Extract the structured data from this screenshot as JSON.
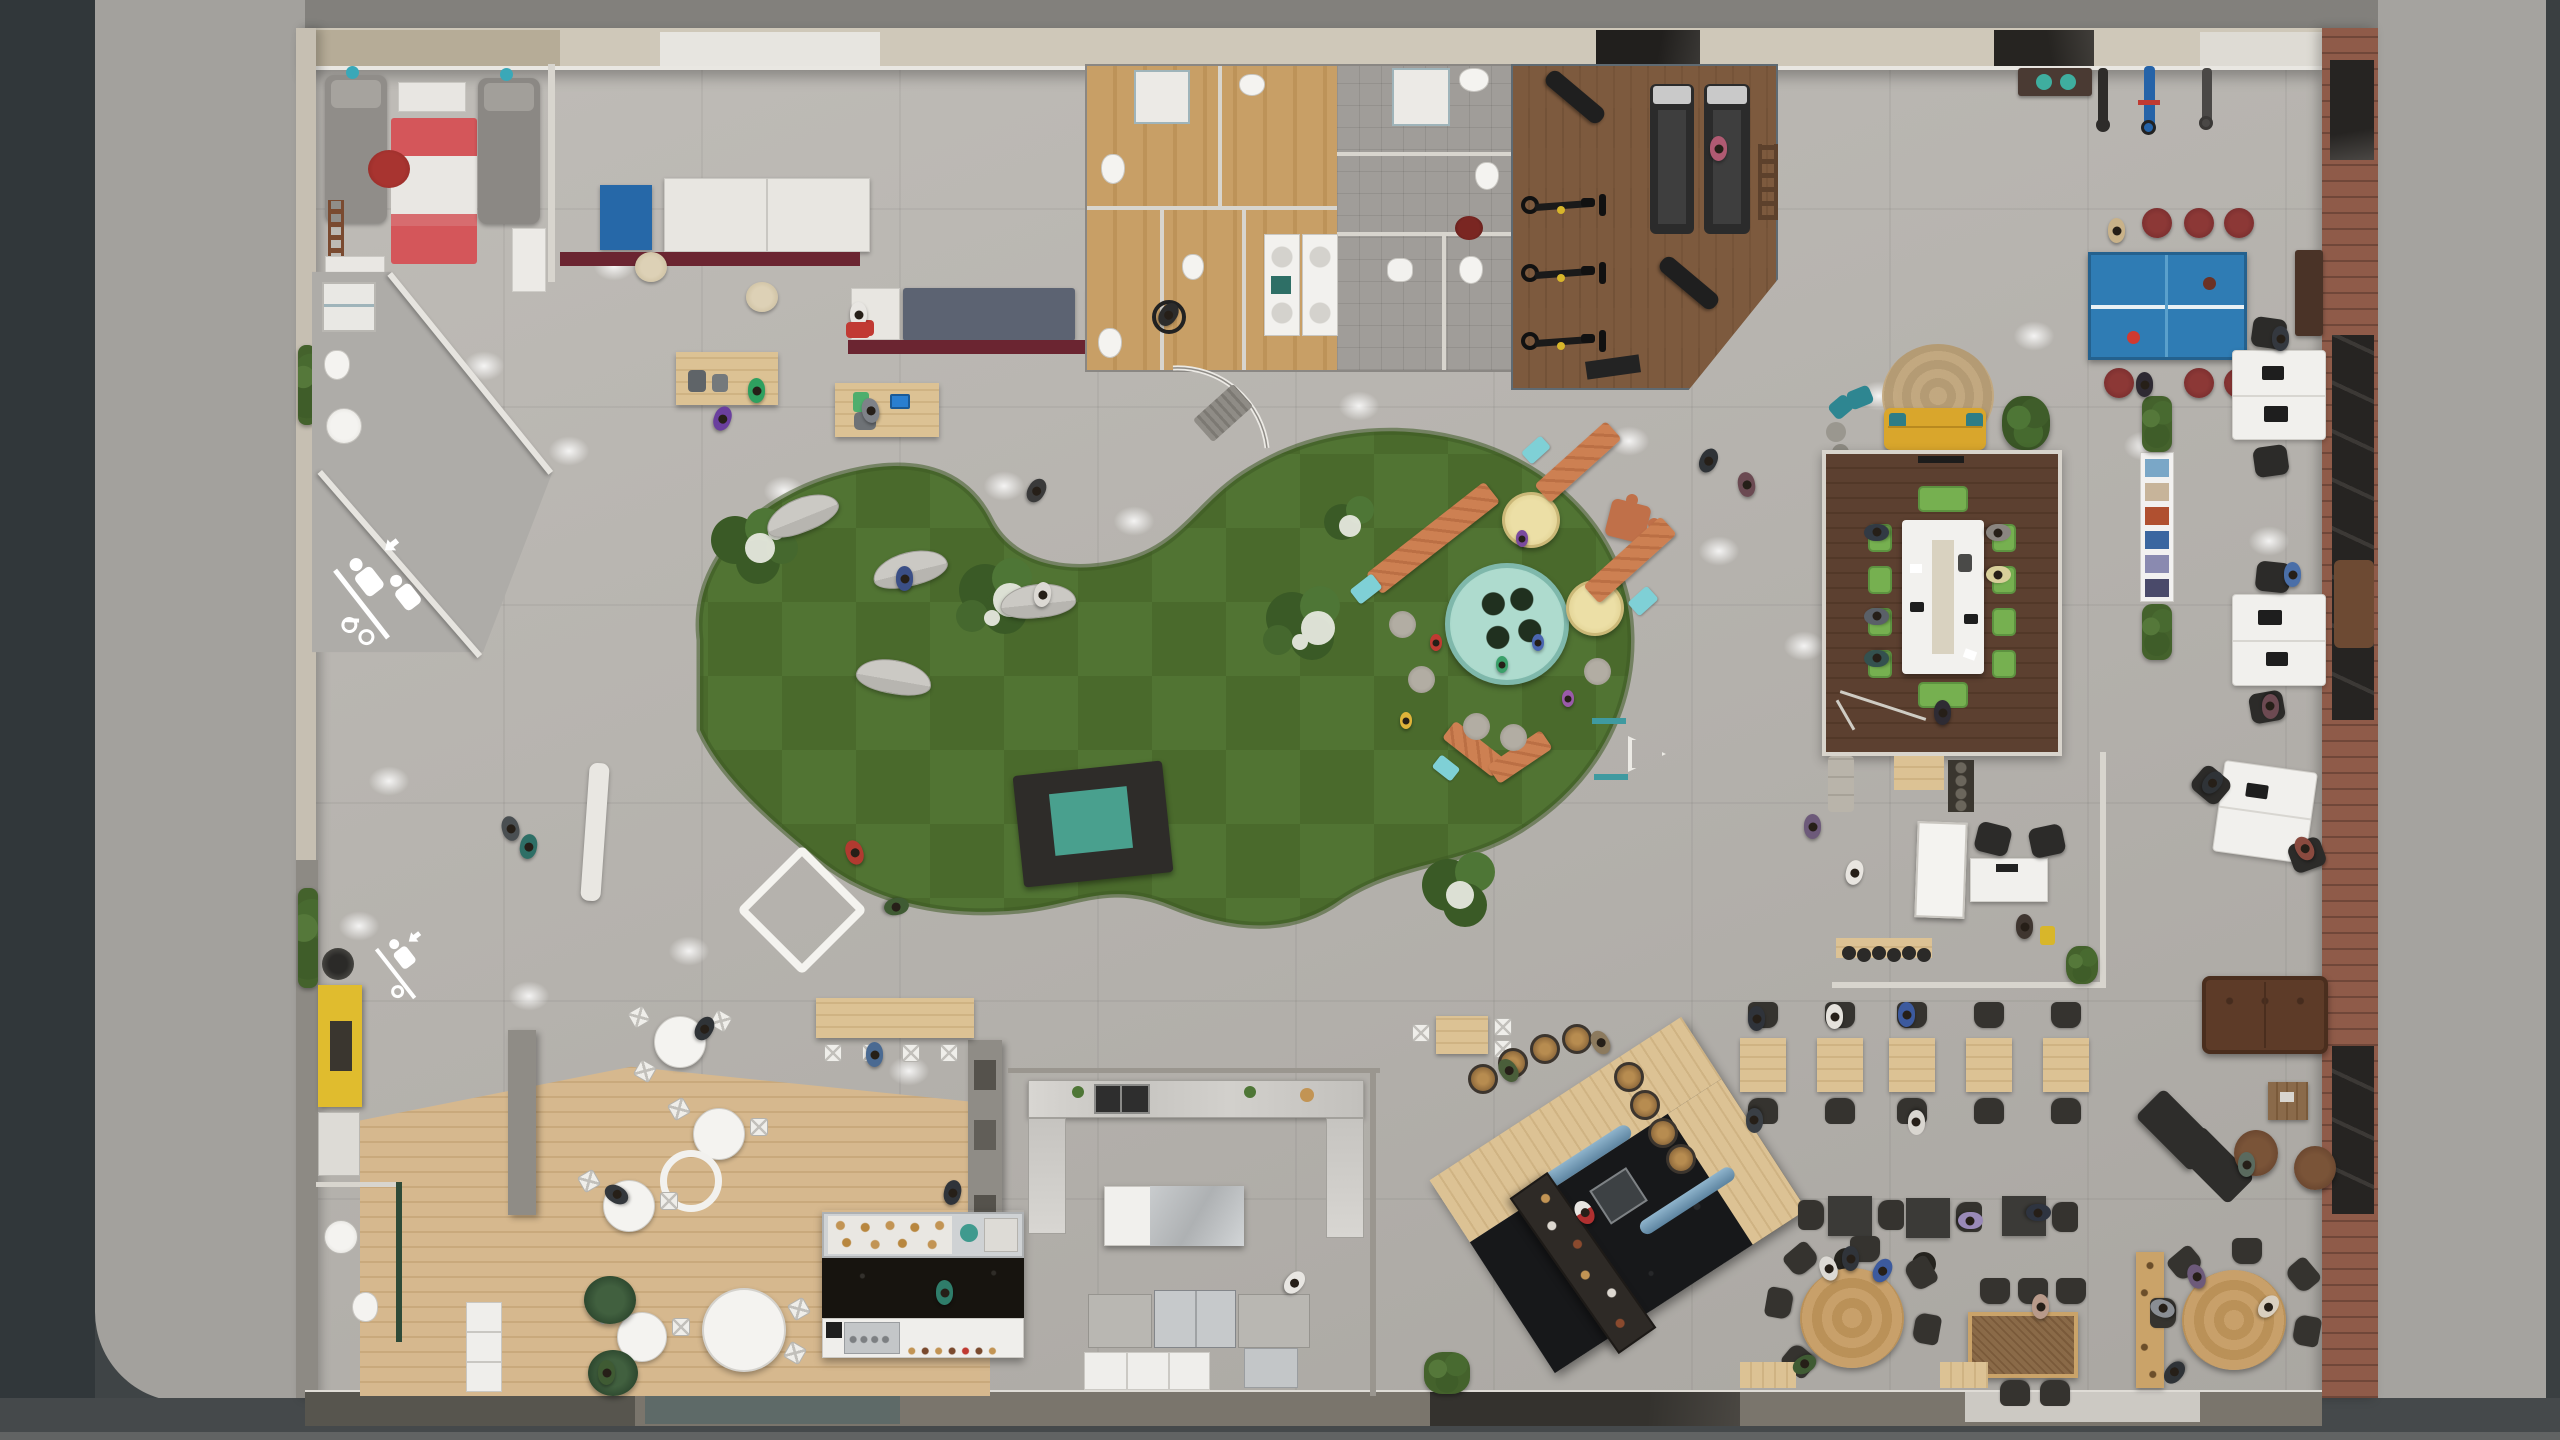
{
  "scene": {
    "title": "Top-down 3D architectural render of an open-plan office / coworking floor",
    "view": "orthographic top-down",
    "palette": {
      "street": "#3f4446",
      "sidewalk": "#a3a19d",
      "interior_concrete": "#bab7b2",
      "lawn_green_light": "#517433",
      "lawn_green_dark": "#4a6a2c",
      "cafe_wood": "#d6b88e",
      "restroom_wood": "#c89f66",
      "gym_wood": "#7d5a3e",
      "meeting_room_wood": "#5c4030",
      "pine_furniture": "#dcc294",
      "maroon_counter": "#6b2531",
      "navy_bench": "#5c6372",
      "ping_pong_blue": "#2f7cb4",
      "stool_dark_red": "#7c2f30",
      "conference_chair_green": "#76b050",
      "play_teal": "#7fd0d6",
      "pool_teal": "#a9d9cc",
      "play_orange": "#cd8052",
      "sofa_yellow": "#d9a62c",
      "booth_yellow": "#e0bc2e",
      "brick_wall": "#8f5b49",
      "black_marble": "#26221f",
      "leather_brown": "#5d3b28",
      "barrel_wood": "#a07844",
      "rug_red": "#d4565a"
    }
  },
  "zones": {
    "street": {
      "label": "Street pavement"
    },
    "sidewalk": {
      "label": "Sidewalk"
    },
    "building": {
      "label": "Open-plan office floor"
    },
    "napRoom": {
      "label": "Nap room with beds and striped rug"
    },
    "napBath": {
      "label": "Bathroom with angled glass walls"
    },
    "flexLounge": {
      "label": "Lobby flex lounge with cabinets, benches and picnic tables"
    },
    "restrooms": {
      "label": "Restroom block with wooden stalls and tiled showers"
    },
    "gym": {
      "label": "Fitness area with treadmills, spin bikes and benches"
    },
    "entrance": {
      "label": "Curved glass entrance"
    },
    "lawn": {
      "label": "Indoor lawn with checkered mowing pattern"
    },
    "playground": {
      "label": "Kids playground with button pool and stepped benches"
    },
    "pingpong": {
      "label": "Ping-pong corner"
    },
    "bikeParking": {
      "label": "Indoor bike parking"
    },
    "yellowLounge": {
      "label": "Yellow sofa lounge"
    },
    "meetingRoom": {
      "label": "Conference room with green chairs"
    },
    "serviceBar": {
      "label": "Glass service desk enclosure"
    },
    "deskRow": {
      "label": "Workstation desk pairs"
    },
    "magazineRack": {
      "label": "Magazine rack with hedge planters"
    },
    "cafe": {
      "label": "Cafe seating on wooden floor"
    },
    "cafeCounter": {
      "label": "Bakery and coffee counter"
    },
    "kitchen": {
      "label": "Commercial kitchen with granite counters"
    },
    "bar": {
      "label": "Rotated bar island with barrel stools"
    },
    "dining": {
      "label": "Dining and collaboration tables"
    },
    "leatherLounge": {
      "label": "Leather chesterfield lounge"
    },
    "wc": {
      "label": "Small WC"
    },
    "phoneBooth": {
      "label": "Yellow phone booth"
    }
  },
  "icons": [
    {
      "name": "pedestrian-bicycle-floor-marking",
      "description": "white painted pedestrians, bicycle and arrow on concrete"
    },
    {
      "name": "diamond-floor-marking",
      "description": "white diamond outline painted on lawn"
    },
    {
      "name": "triangle-floor-marking",
      "description": "white triangle outline painted on lawn"
    }
  ],
  "objects": {
    "ping_pong_tables": 1,
    "ping_pong_stools": 6,
    "barrel_stools": 8,
    "treadmills": 2,
    "spin_bikes": 3,
    "workout_benches": 2,
    "parked_bicycles": 3,
    "conference_chairs": 8,
    "conference_benches": 2,
    "picnic_tables": 4,
    "curved_lawn_benches": 4,
    "stepping_stones": 5,
    "small_dining_tables": 5,
    "dark_square_tables": 3,
    "round_dining_tables": 2,
    "round_cafe_tables": 4,
    "desk_pairs": 3,
    "approx_people_visible": 55
  }
}
